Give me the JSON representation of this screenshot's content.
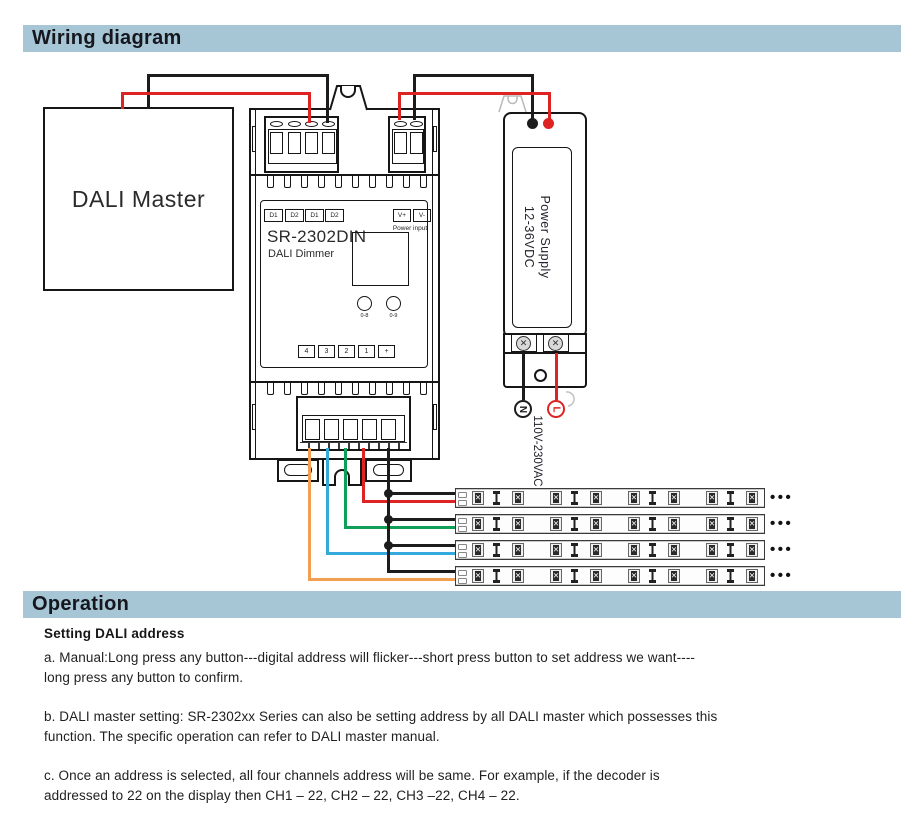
{
  "sections": {
    "wiring_title": "Wiring diagram",
    "operation_title": "Operation"
  },
  "diagram": {
    "dali_master_label": "DALI Master",
    "dimmer": {
      "model": "SR-2302DIN",
      "subtitle": "DALI Dimmer",
      "dali_terminals": [
        "D1",
        "D2",
        "D1",
        "D2"
      ],
      "power_terminals": [
        "V+",
        "V-"
      ],
      "power_input_caption": "Power input",
      "buttons": [
        "0-8",
        "0-9"
      ],
      "output_terminals": [
        "4",
        "3",
        "2",
        "1",
        "+"
      ]
    },
    "power_supply": {
      "name": "Power Supply",
      "rating": "12-36VDC",
      "neutral": "N",
      "live": "L",
      "mains": "110V-230VAC"
    },
    "led_strip_ellipsis": "•••",
    "colors": {
      "red": "#dd2423",
      "black": "#1c1c1c",
      "green": "#0f9f57",
      "blue": "#35a9dc",
      "orange": "#f0a050",
      "header_bg": "#a7c6d5"
    }
  },
  "operation": {
    "heading": "Setting DALI address",
    "para_a": "a. Manual:Long press any button---digital address will flicker---short press button to set address we want----\nlong press any button to confirm.",
    "para_b": "b. DALI master setting: SR-2302xx Series can also be setting address by all DALI master which possesses this\nfunction. The specific operation can refer to DALI master manual.",
    "para_c": "c. Once an address is selected, all four channels address will be same. For example, if the decoder is\naddressed to 22 on the display then CH1 – 22, CH2 – 22, CH3 –22, CH4 – 22."
  }
}
